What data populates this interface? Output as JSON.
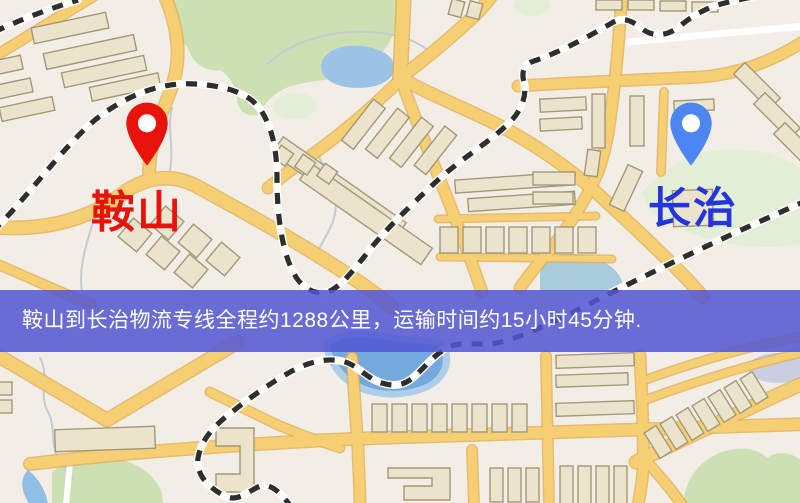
{
  "map": {
    "origin": {
      "name": "鞍山",
      "pin_icon": "red-map-pin",
      "pin_color": "#e8130a",
      "label_color": "#e8130a"
    },
    "destination": {
      "name": "长治",
      "pin_icon": "blue-map-pin",
      "pin_color": "#4d86f0",
      "label_color": "#2335dd"
    },
    "style_colors": {
      "background": "#f3eee5",
      "road_fill": "#f6cf72",
      "road_casing": "#e3aa52",
      "building_fill": "#ebe3cb",
      "building_stroke": "#a39877",
      "green_area": "#cde0b3",
      "green_area_light": "#e3eed6",
      "pond_water": "#9cc2e6",
      "lake_water": "#73a9dc",
      "railway": "#2e2e2e"
    }
  },
  "banner": {
    "text": "鞍山到长治物流专线全程约1288公里，运输时间约15小时45分钟.",
    "background_color": "#5356d3",
    "text_color": "#ffffff",
    "route_origin": "鞍山",
    "route_destination": "长治",
    "distance_text": "约1288公里",
    "duration_text": "约15小时45分钟"
  }
}
